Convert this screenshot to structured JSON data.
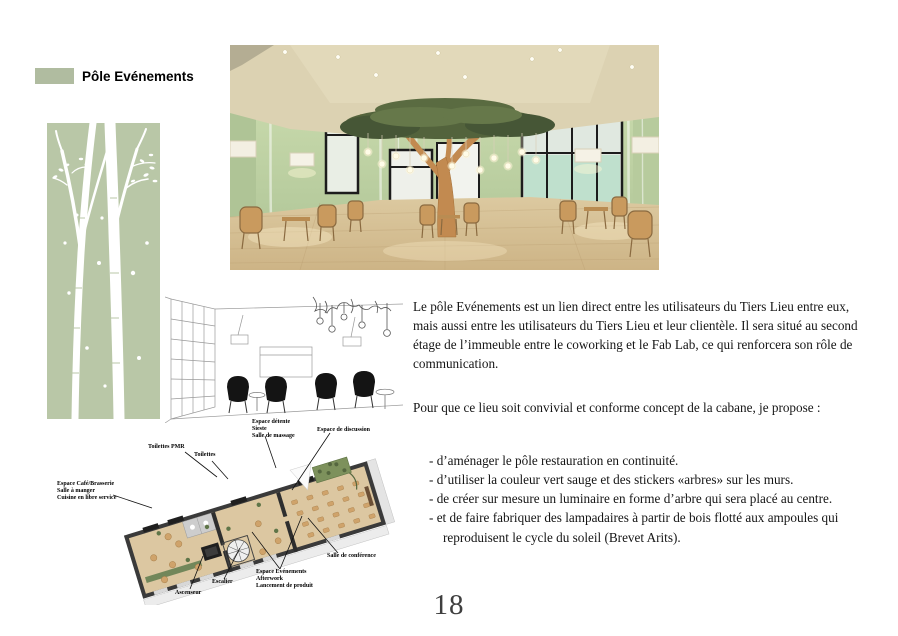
{
  "header": {
    "title": "Pôle Evénements",
    "swatch_color": "#b0bca0"
  },
  "colors": {
    "sage_green_panel": "#b9c7a7",
    "render_wall_green": "#bfd2a4",
    "render_ceiling_cream": "#dcd2b2",
    "render_floor_wood": "#d9c79d",
    "frame_black": "#1c1c1c",
    "mint_glass": "#bfe0cd"
  },
  "main_text": {
    "paragraph1": "Le pôle Evénements est un lien direct entre les utilisateurs du Tiers Lieu entre eux, mais aussi entre les utilisateurs du Tiers Lieu et leur clientèle. Il sera situé au second étage de l’immeuble entre le coworking et le Fab Lab, ce qui renforcera son rôle de communication.",
    "paragraph2": "Pour que ce lieu soit convivial et conforme concept de la cabane, je propose :",
    "bullets": [
      "- d’aménager le pôle restauration en continuité.",
      "- d’utiliser la couleur vert sauge et des stickers «arbres» sur les murs.",
      "- de créer sur mesure un luminaire en forme d’arbre qui sera placé au centre.",
      "- et de faire fabriquer des lampadaires à partir de bois flotté aux ampoules qui reproduisent le cycle du soleil (Brevet Arits)."
    ]
  },
  "sketch_labels": {
    "detente": "Espace détente\nSieste\nSalle de massage",
    "discussion": "Espace de discussion"
  },
  "plan_labels": {
    "toilettes_pmr": "Toilettes PMR",
    "toilettes": "Toilettes",
    "cafe": "Espace Café/Brasserie\nSalle à manger\nCuisine en libre service",
    "conference": "Salle de conférence",
    "escalier": "Escalier",
    "ascenseur": "Ascenseur",
    "evenements": "Espace Evénements\nAfterwork\nLancement de produit"
  },
  "footer": {
    "page_number": "18"
  }
}
